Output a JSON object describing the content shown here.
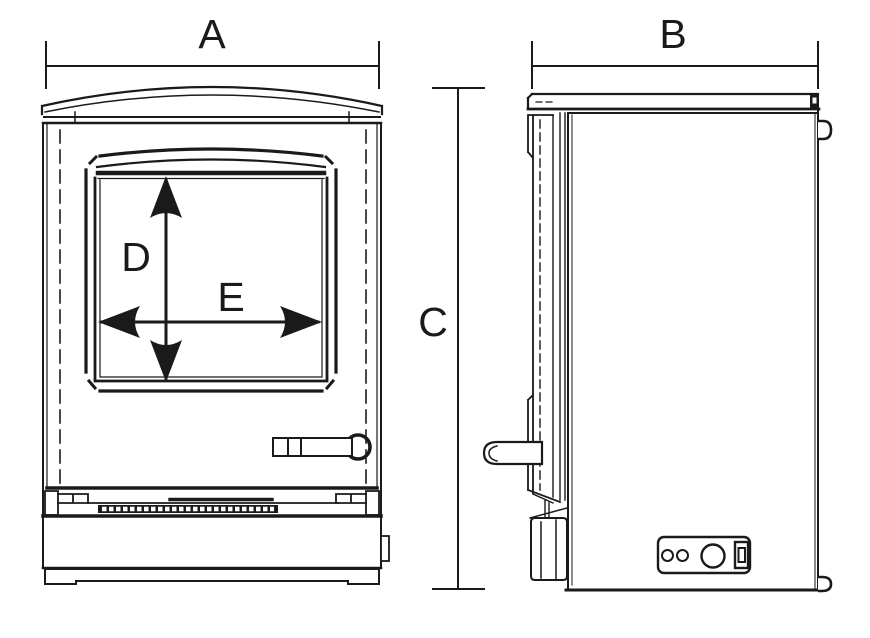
{
  "canvas": {
    "background": "#ffffff",
    "line_color": "#1a1a1a"
  },
  "dimensions": {
    "front_width": {
      "label": "A"
    },
    "side_depth": {
      "label": "B"
    },
    "overall_height": {
      "label": "C"
    },
    "window_height": {
      "label": "D"
    },
    "window_width": {
      "label": "E"
    }
  }
}
